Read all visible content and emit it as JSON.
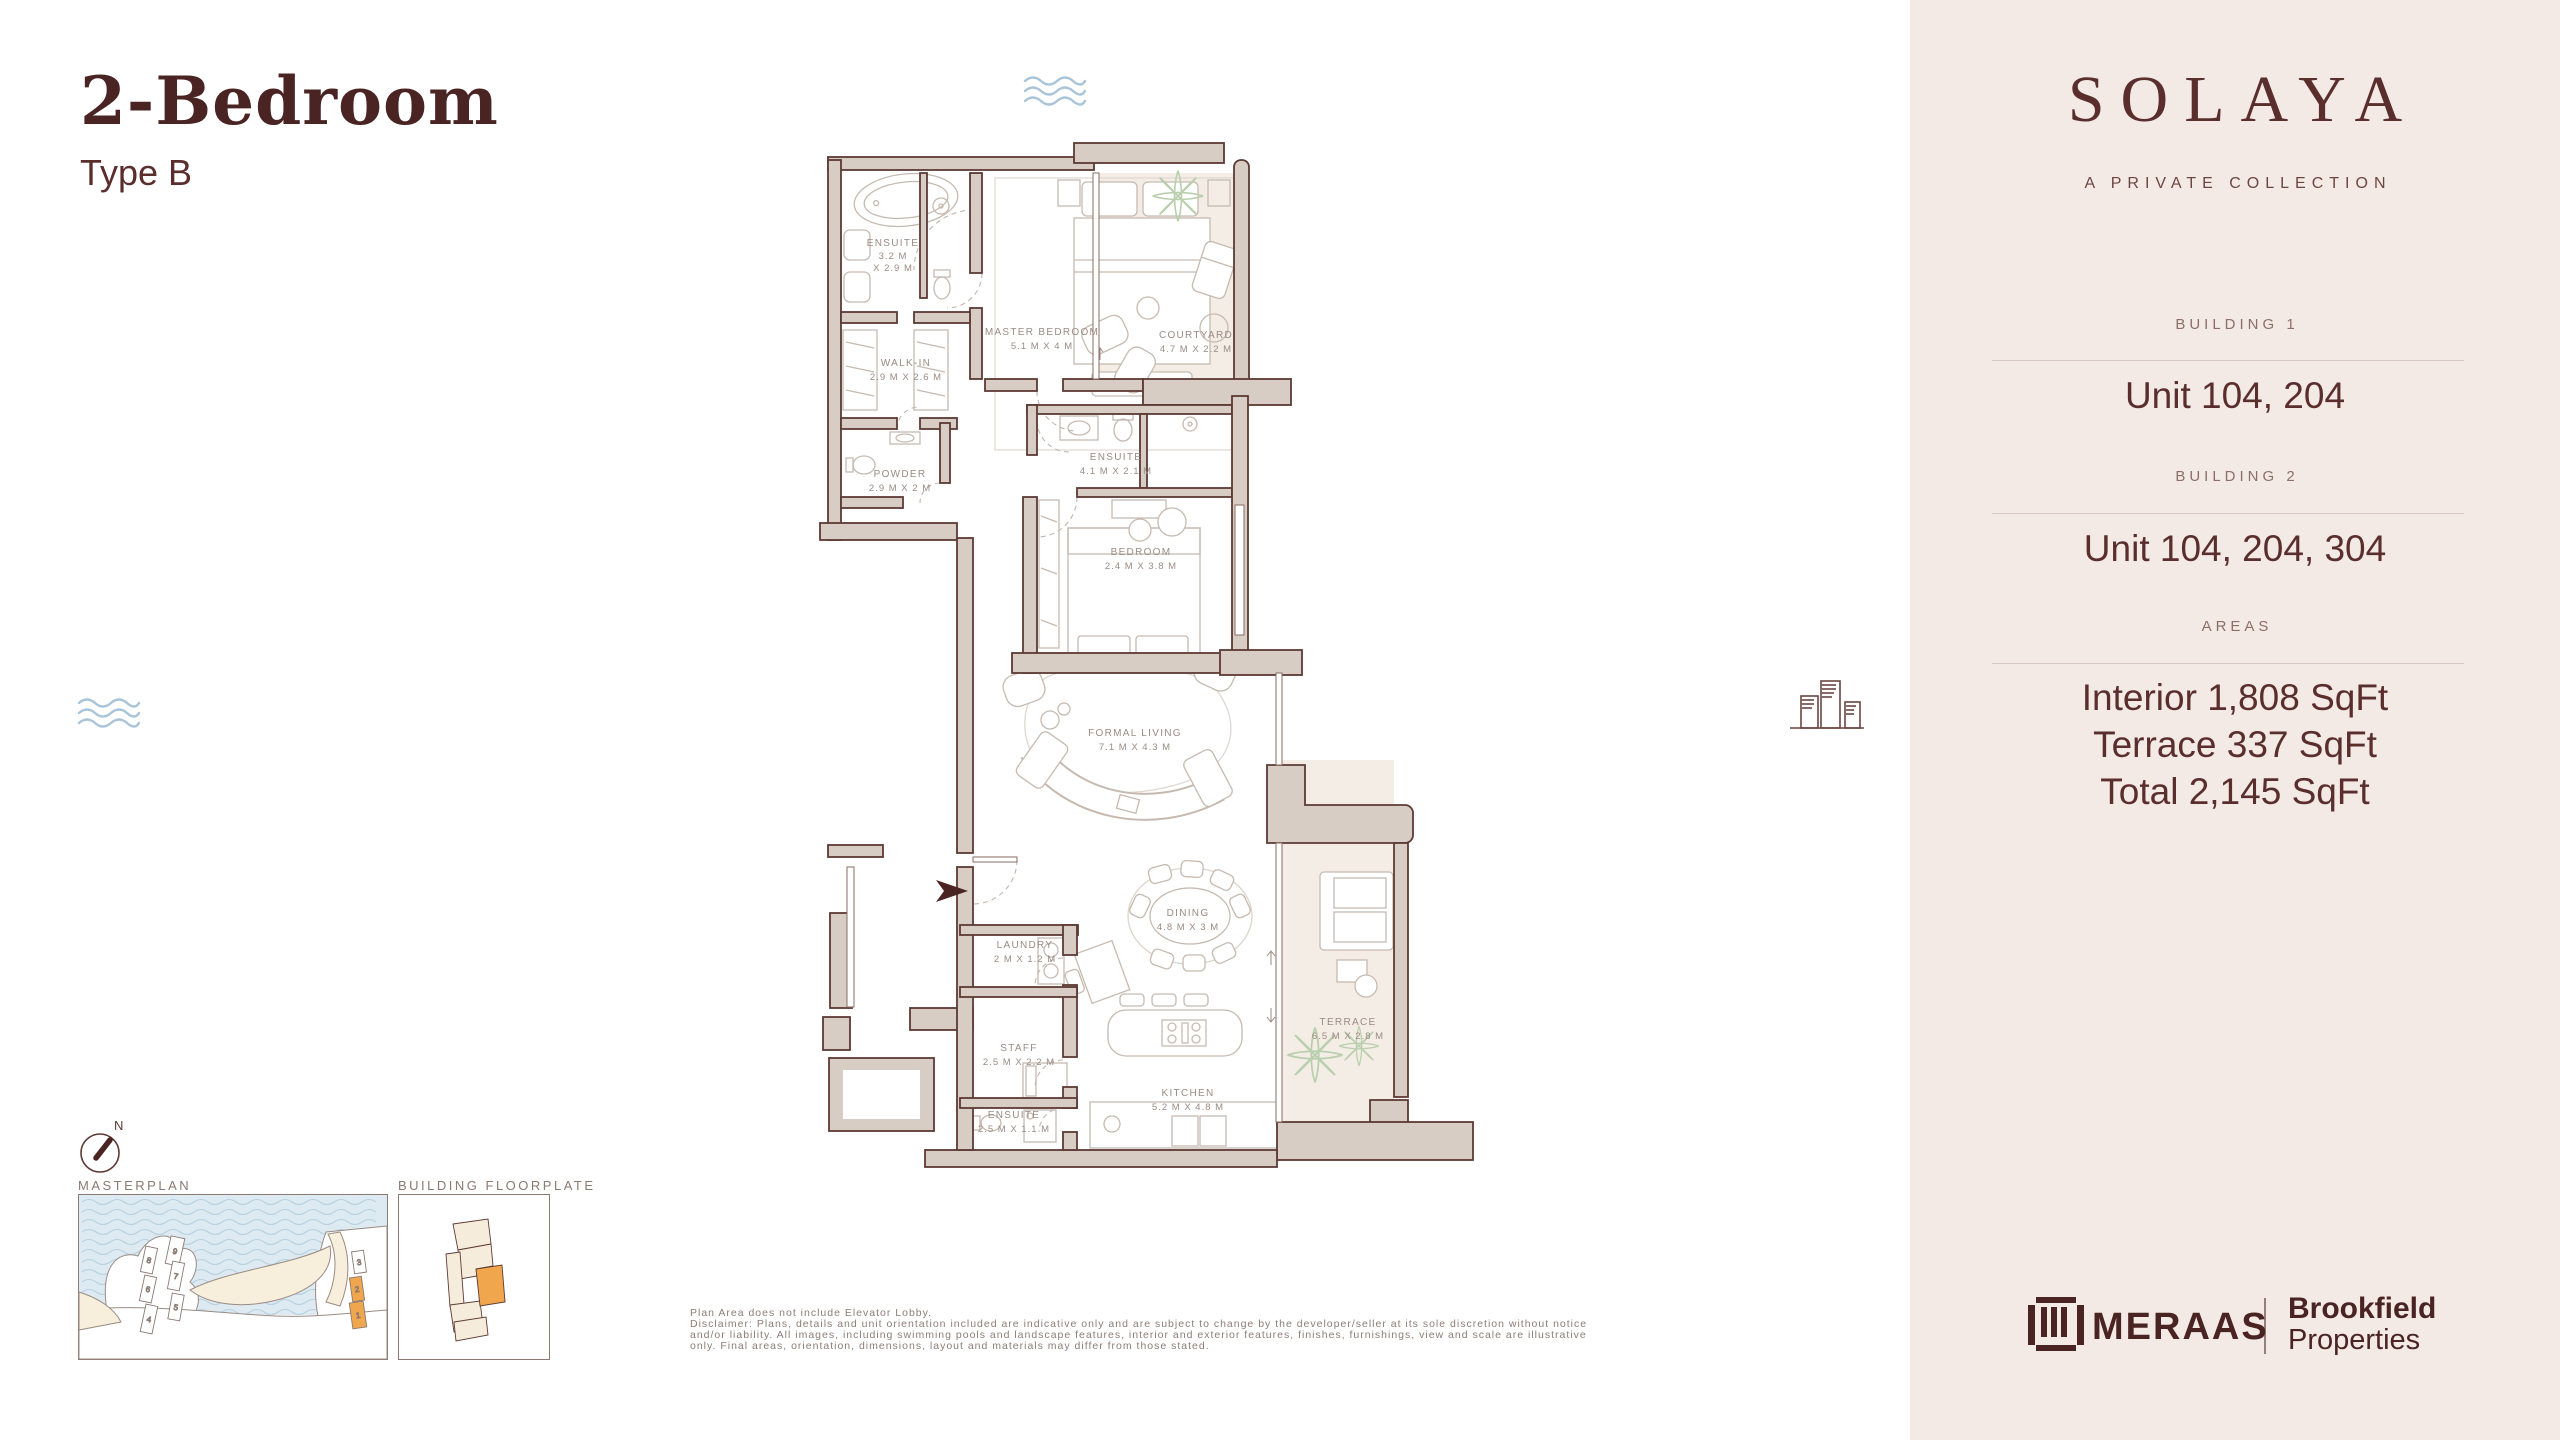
{
  "page": {
    "title": "2-Bedroom",
    "subtitle": "Type B"
  },
  "sidebar": {
    "brand": "SOLAYA",
    "tagline": "A PRIVATE COLLECTION",
    "sections": [
      {
        "label": "BUILDING 1",
        "value": "Unit 104, 204"
      },
      {
        "label": "BUILDING 2",
        "value": "Unit 104, 204, 304"
      },
      {
        "label": "AREAS",
        "value_lines": [
          "Interior 1,808 SqFt",
          "Terrace 337 SqFt",
          "Total 2,145 SqFt"
        ]
      }
    ],
    "logos": {
      "meraas": "MERAAS",
      "brookfield_line1": "Brookfield",
      "brookfield_line2": "Properties"
    }
  },
  "plan": {
    "compass_label": "N",
    "rooms": [
      {
        "name": "ENSUITE",
        "dims": "3.2 M",
        "dims2": "X 2.9 M"
      },
      {
        "name": "MASTER BEDROOM",
        "dims": "5.1 M X 4 M"
      },
      {
        "name": "COURTYARD",
        "dims": "4.7 M X 2.2 M"
      },
      {
        "name": "WALK-IN",
        "dims": "2.9 M X 2.6 M"
      },
      {
        "name": "POWDER",
        "dims": "2.9 M X 2 M"
      },
      {
        "name": "ENSUITE",
        "dims": "4.1 M X 2.1 M"
      },
      {
        "name": "BEDROOM",
        "dims": "2.4 M X 3.8 M"
      },
      {
        "name": "FORMAL LIVING",
        "dims": "7.1 M X 4.3 M"
      },
      {
        "name": "DINING",
        "dims": "4.8 M X 3 M"
      },
      {
        "name": "LAUNDRY",
        "dims": "2 M X 1.2 M"
      },
      {
        "name": "STAFF",
        "dims": "2.5 M X 2.2 M"
      },
      {
        "name": "ENSUITE",
        "dims": "2.5 M X 1.1 M"
      },
      {
        "name": "KITCHEN",
        "dims": "5.2 M X 4.8 M"
      },
      {
        "name": "TERRACE",
        "dims": "6.5 M X 2.8 M"
      }
    ],
    "thumbnails": {
      "masterplan_label": "MASTERPLAN",
      "floorplate_label": "BUILDING FLOORPLATE",
      "units": [
        "9",
        "8",
        "7",
        "6",
        "5",
        "4",
        "3",
        "2",
        "1"
      ]
    }
  },
  "disclaimer": {
    "line1": "Plan Area does not include Elevator Lobby.",
    "line2": "Disclaimer: Plans, details and unit orientation included are indicative only and are subject to change by the developer/seller at its sole discretion without notice",
    "line3": "and/or liability. All images, including swimming pools and landscape features, interior and exterior features, finishes, furnishings, view and scale are illustrative",
    "line4": "only. Final areas, orientation, dimensions, layout and materials may differ from those stated."
  },
  "colors": {
    "brand_maroon": "#4a2423",
    "sidebar_bg": "#f3eae5",
    "wall_fill": "#d8cdc5",
    "wall_stroke": "#5d3a34",
    "accent_orange": "#f0a64c",
    "water_blue": "#ddeaf2",
    "leaf_green": "#b9cfae",
    "furniture_line": "#c6bab0",
    "label_gray": "#9b8b83"
  }
}
